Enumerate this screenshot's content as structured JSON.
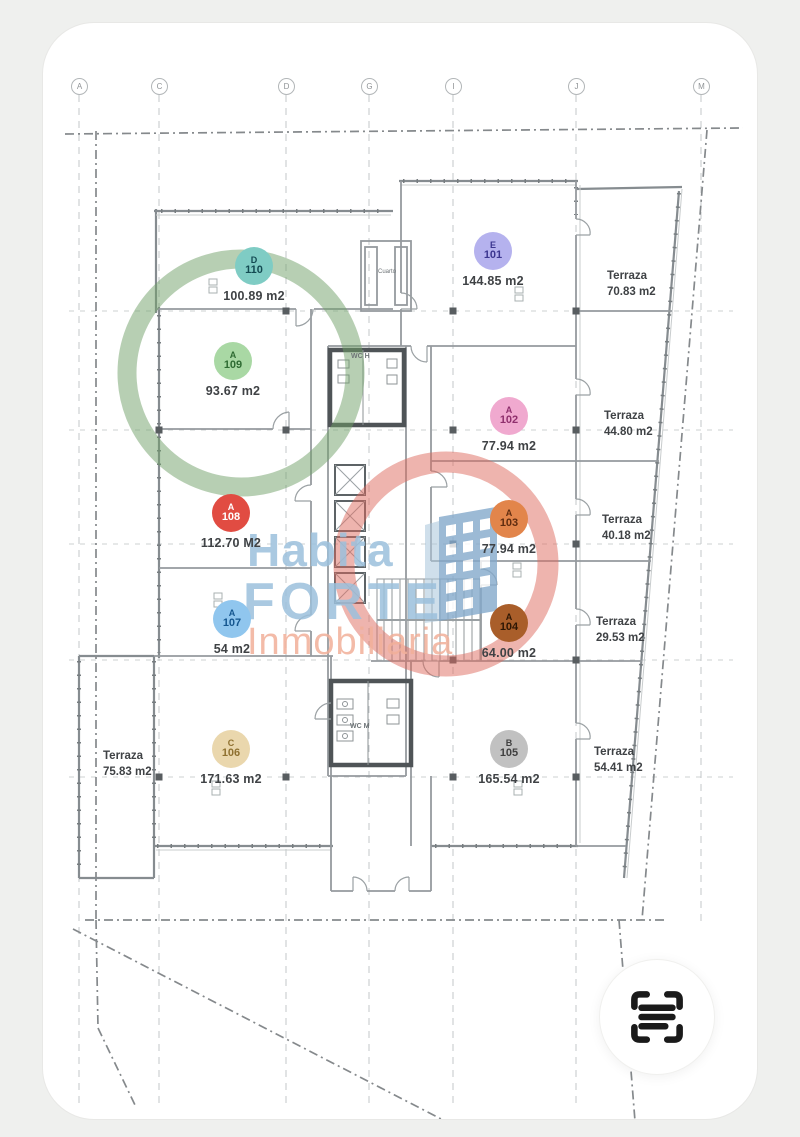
{
  "grid_letters": [
    {
      "label": "A"
    },
    {
      "label": "C"
    },
    {
      "label": "D"
    },
    {
      "label": "G"
    },
    {
      "label": "I"
    },
    {
      "label": "J"
    },
    {
      "label": "M"
    }
  ],
  "units": [
    {
      "letter": "D",
      "number": "110",
      "area": "100.89 m2",
      "badge_color": "#7fccc4",
      "text_color": "#134a52"
    },
    {
      "letter": "A",
      "number": "109",
      "area": "93.67 m2",
      "badge_color": "#a9d8a4",
      "text_color": "#2f6b33"
    },
    {
      "letter": "E",
      "number": "101",
      "area": "144.85 m2",
      "badge_color": "#b5b2ee",
      "text_color": "#3c3690"
    },
    {
      "letter": "A",
      "number": "102",
      "area": "77.94 m2",
      "badge_color": "#f0a9cf",
      "text_color": "#8f2f6d"
    },
    {
      "letter": "A",
      "number": "108",
      "area": "112.70 M2",
      "badge_color": "#e14c42",
      "text_color": "#ffffff"
    },
    {
      "letter": "A",
      "number": "103",
      "area": "77.94 m2",
      "badge_color": "#e2854b",
      "text_color": "#5f2c10"
    },
    {
      "letter": "A",
      "number": "107",
      "area": "54 m2",
      "badge_color": "#90c6ee",
      "text_color": "#15568f"
    },
    {
      "letter": "A",
      "number": "104",
      "area": "64.00 m2",
      "badge_color": "#a95e2a",
      "text_color": "#2e1704"
    },
    {
      "letter": "C",
      "number": "106",
      "area": "171.63 m2",
      "badge_color": "#ead7ad",
      "text_color": "#8f7130"
    },
    {
      "letter": "B",
      "number": "105",
      "area": "165.54 m2",
      "badge_color": "#c1c1c1",
      "text_color": "#3f3f3f"
    }
  ],
  "terrazas": [
    {
      "label": "Terraza",
      "area": "70.83 m2"
    },
    {
      "label": "Terraza",
      "area": "44.80 m2"
    },
    {
      "label": "Terraza",
      "area": "40.18 m2"
    },
    {
      "label": "Terraza",
      "area": "29.53 m2"
    },
    {
      "label": "Terraza",
      "area": "54.41 m2"
    },
    {
      "label": "Terraza",
      "area": "75.83 m2"
    }
  ],
  "plan_labels": {
    "wc_top": "WC H",
    "wc_bottom": "WC M",
    "shaft_room": "Cuarto"
  },
  "highlight": {
    "around_unit": "A 109",
    "ring_color": "#6f9f68"
  },
  "watermark": {
    "line1": "Habita",
    "line2": "FORTE",
    "line3": "Inmobiliaria",
    "blue": "#9cc0dc",
    "orange": "#f2b09a",
    "ring_color": "#dd6a5e",
    "building_color": "#84a9cb"
  },
  "scan_button": {
    "icon": "scan-frame-icon",
    "icon_color": "#1a1a1a"
  }
}
